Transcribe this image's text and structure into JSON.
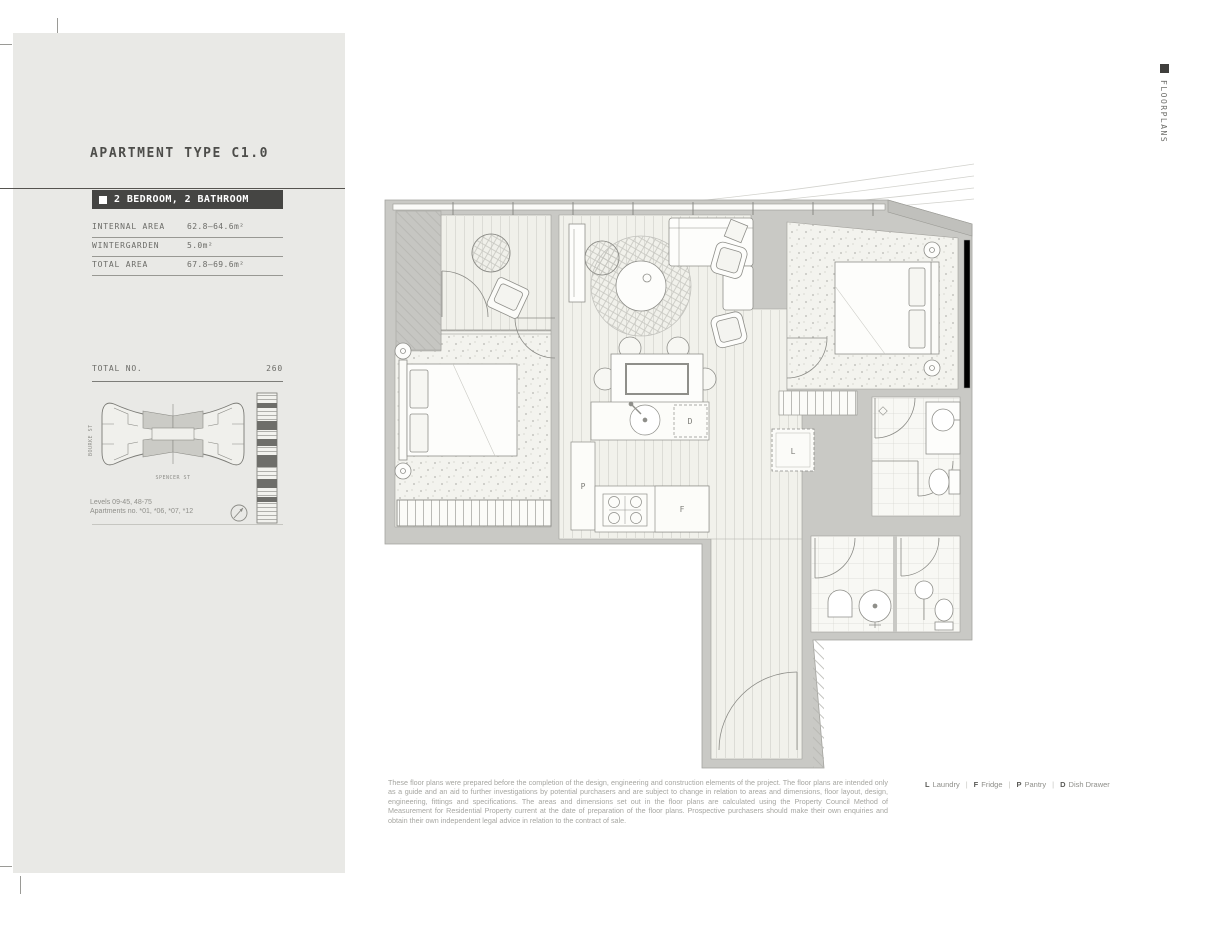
{
  "side_tab": {
    "label": "FLOORPLANS"
  },
  "sidebar": {
    "title": "APARTMENT TYPE C1.0",
    "badge": {
      "label": "2 BEDROOM, 2 BATHROOM"
    },
    "area_table": [
      {
        "label": "INTERNAL AREA",
        "value": "62.8–64.6m²"
      },
      {
        "label": "WINTERGARDEN",
        "value": "5.0m²"
      },
      {
        "label": "TOTAL AREA",
        "value": "67.8–69.6m²"
      }
    ],
    "total": {
      "label": "TOTAL NO.",
      "value": "260"
    },
    "keyplan": {
      "street_left": "BOURKE ST",
      "street_bottom": "SPENCER ST"
    },
    "levels_note": "Levels 09-45, 48-75",
    "apartments_note": "Apartments no. *01, *06, *07, *12"
  },
  "plan": {
    "labels": {
      "pantry": "P",
      "fridge": "F",
      "dish_drawer": "D",
      "laundry": "L"
    }
  },
  "footer": {
    "disclaimer": "These floor plans were prepared before the completion of the design, engineering and construction elements of the project. The floor plans are intended only as a guide and an aid to further investigations by potential purchasers and are subject to change in relation to areas and dimensions, floor layout, design, engineering, fittings and specifications. The areas and dimensions set out in the floor plans are calculated using the Property Council Method of Measurement for Residential Property current at the date of preparation of the floor plans. Prospective purchasers should make their own enquiries and obtain their own independent legal advice in relation to the contract of sale.",
    "legend": [
      {
        "key": "L",
        "label": "Laundry"
      },
      {
        "key": "F",
        "label": "Fridge"
      },
      {
        "key": "P",
        "label": "Pantry"
      },
      {
        "key": "D",
        "label": "Dish Drawer"
      }
    ]
  },
  "colors": {
    "accent_dark": "#454543",
    "panel": "#e9e9e6",
    "wall": "#c9c9c5"
  }
}
